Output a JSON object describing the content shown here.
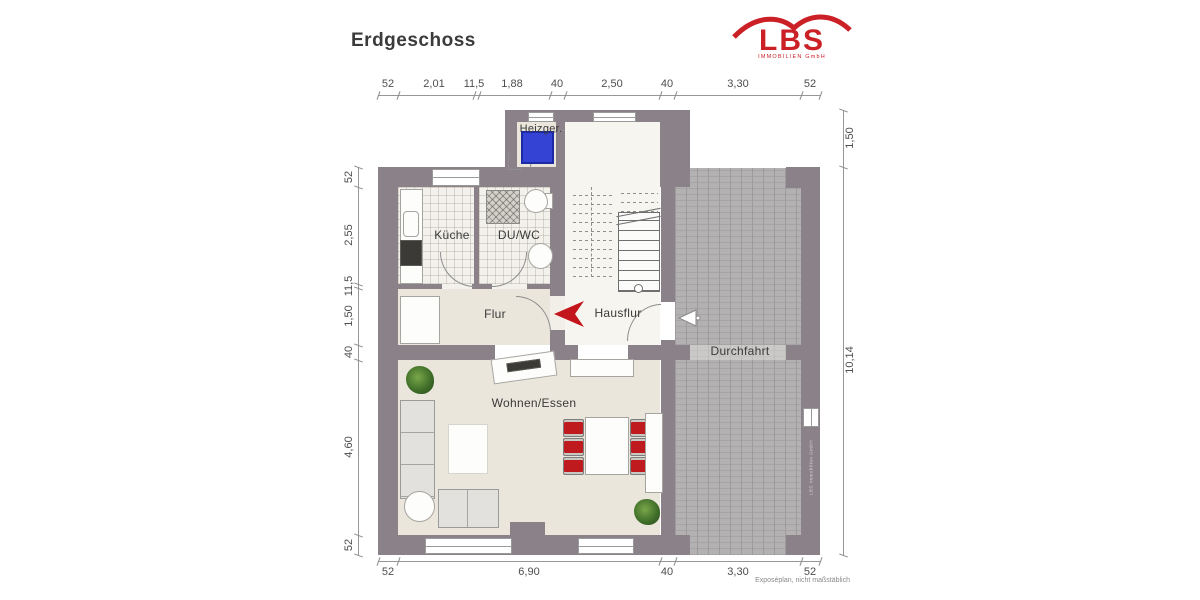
{
  "title": "Erdgeschoss",
  "logo": {
    "name": "LBS",
    "subtitle": "IMMOBILIEN GmbH",
    "color": "#cb2026"
  },
  "rooms": {
    "heizgeraet": "Heizger.",
    "kueche": "Küche",
    "du_wc": "DU/WC",
    "flur": "Flur",
    "hausflur": "Hausflur",
    "wohnen_essen": "Wohnen/Essen",
    "durchfahrt": "Durchfahrt"
  },
  "dimensions": {
    "top": [
      "52",
      "2,01",
      "11,5",
      "1,88",
      "40",
      "2,50",
      "40",
      "3,30",
      "52"
    ],
    "left": [
      "52",
      "2,55",
      "11,5",
      "1,50",
      "40",
      "4,60",
      "52"
    ],
    "right": [
      "1,50",
      "10,14"
    ],
    "bottom": [
      "52",
      "6,90",
      "40",
      "3,30",
      "52"
    ]
  },
  "footnote": "Exposéplan, nicht maßstäblich",
  "watermark": "LBS Immobilien GmbH",
  "colors": {
    "wall": "#8b8188",
    "floor": "#ebe6dc",
    "tile": "#f3f1ec",
    "paving": "#b4b1b3",
    "heater_blue": "#3443d4",
    "accent_red": "#c3161c"
  }
}
